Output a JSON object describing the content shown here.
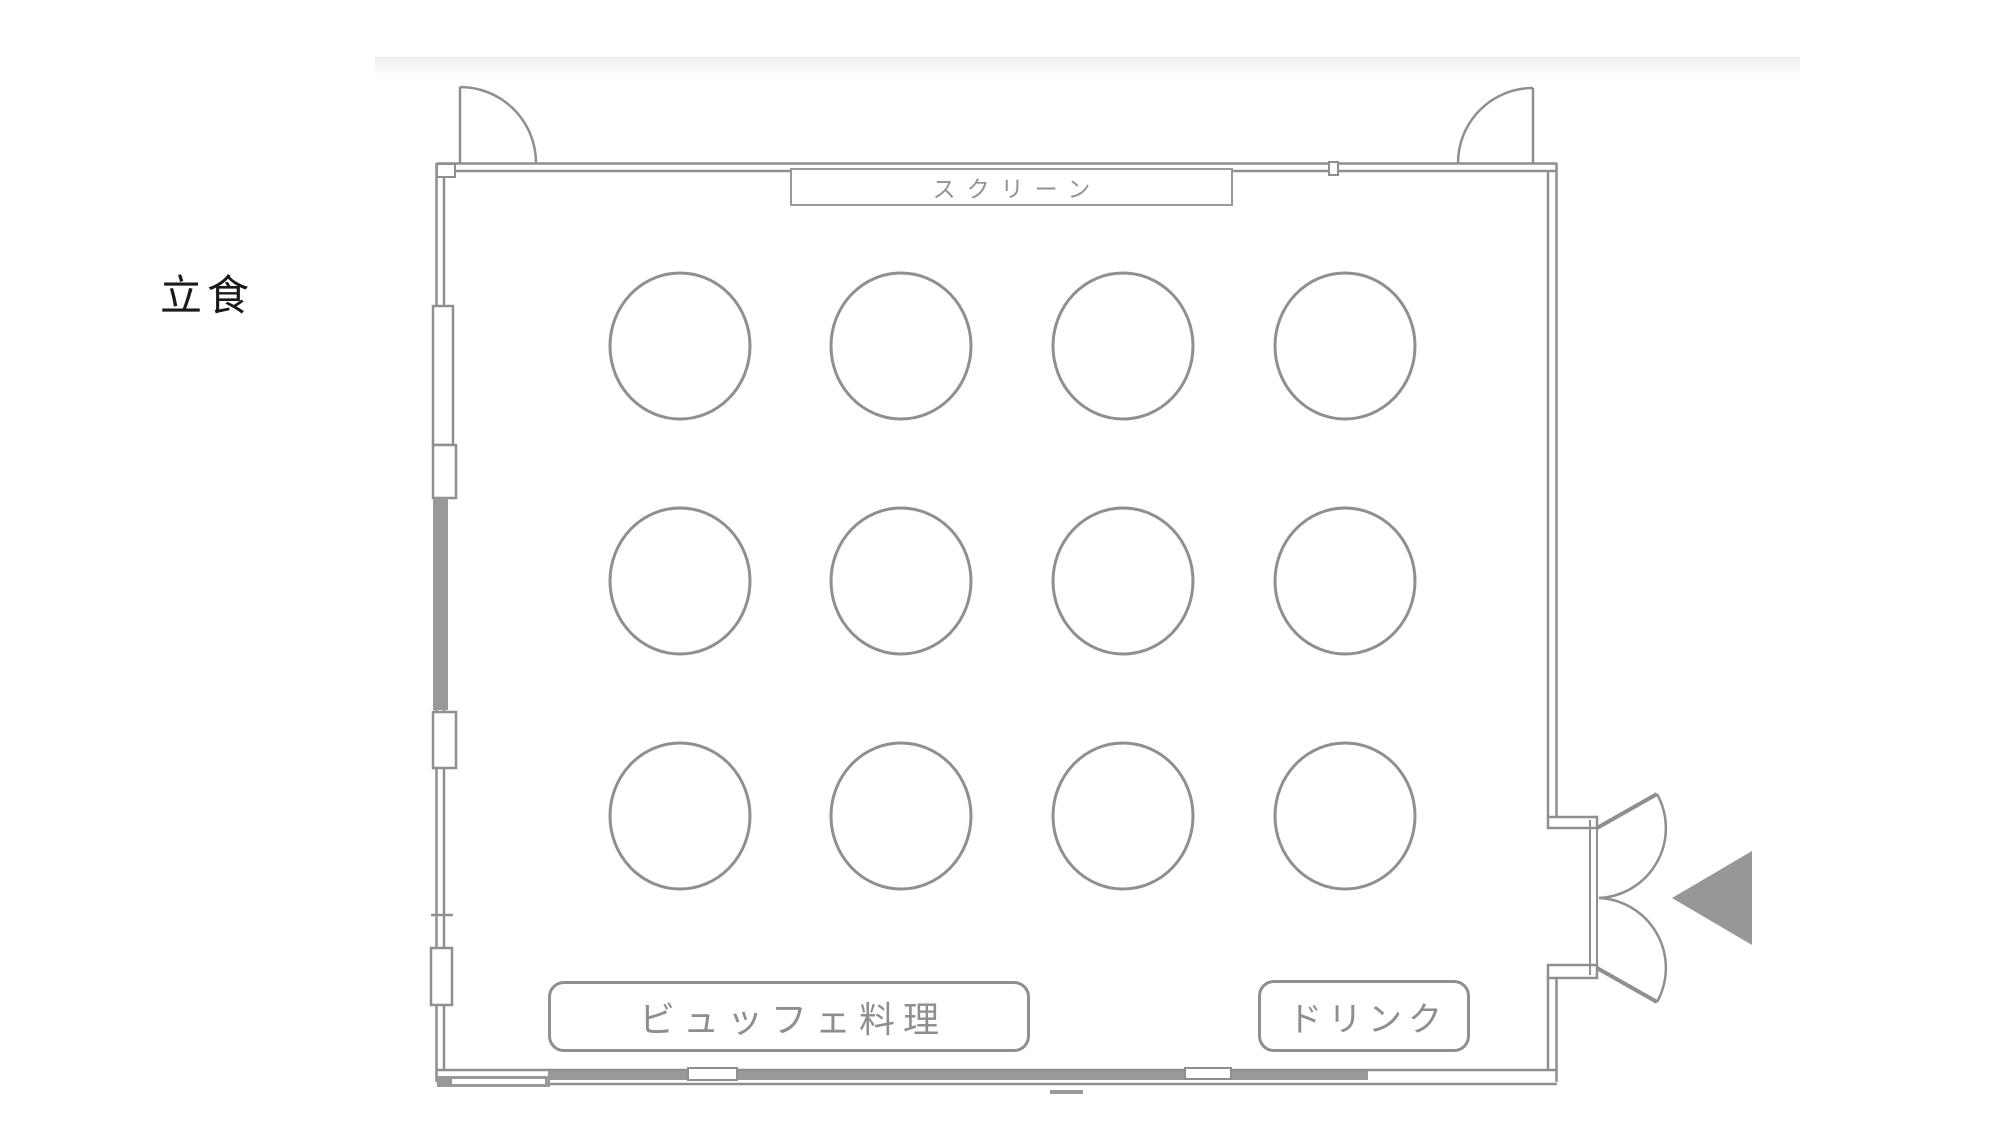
{
  "floor_plan": {
    "event_type_label": "立食",
    "screen": {
      "label": "スクリーン"
    },
    "buffet_table": {
      "label": "ビュッフェ料理"
    },
    "drink_table": {
      "label": "ドリンク"
    },
    "tables": {
      "rows": 3,
      "columns": 4,
      "count": 12,
      "shape": "round"
    },
    "doors": {
      "top_left": "single-swing-door",
      "top_right": "single-swing-door",
      "right": "double-swing-door-with-entry-arrow"
    },
    "entry_arrow": {
      "direction": "left"
    },
    "colors": {
      "wall": "#8f8f8f",
      "wall_fill": "#999999",
      "label_text": "#929292",
      "event_type_text": "#1a1a1a",
      "arrow_fill": "#97979a"
    }
  }
}
